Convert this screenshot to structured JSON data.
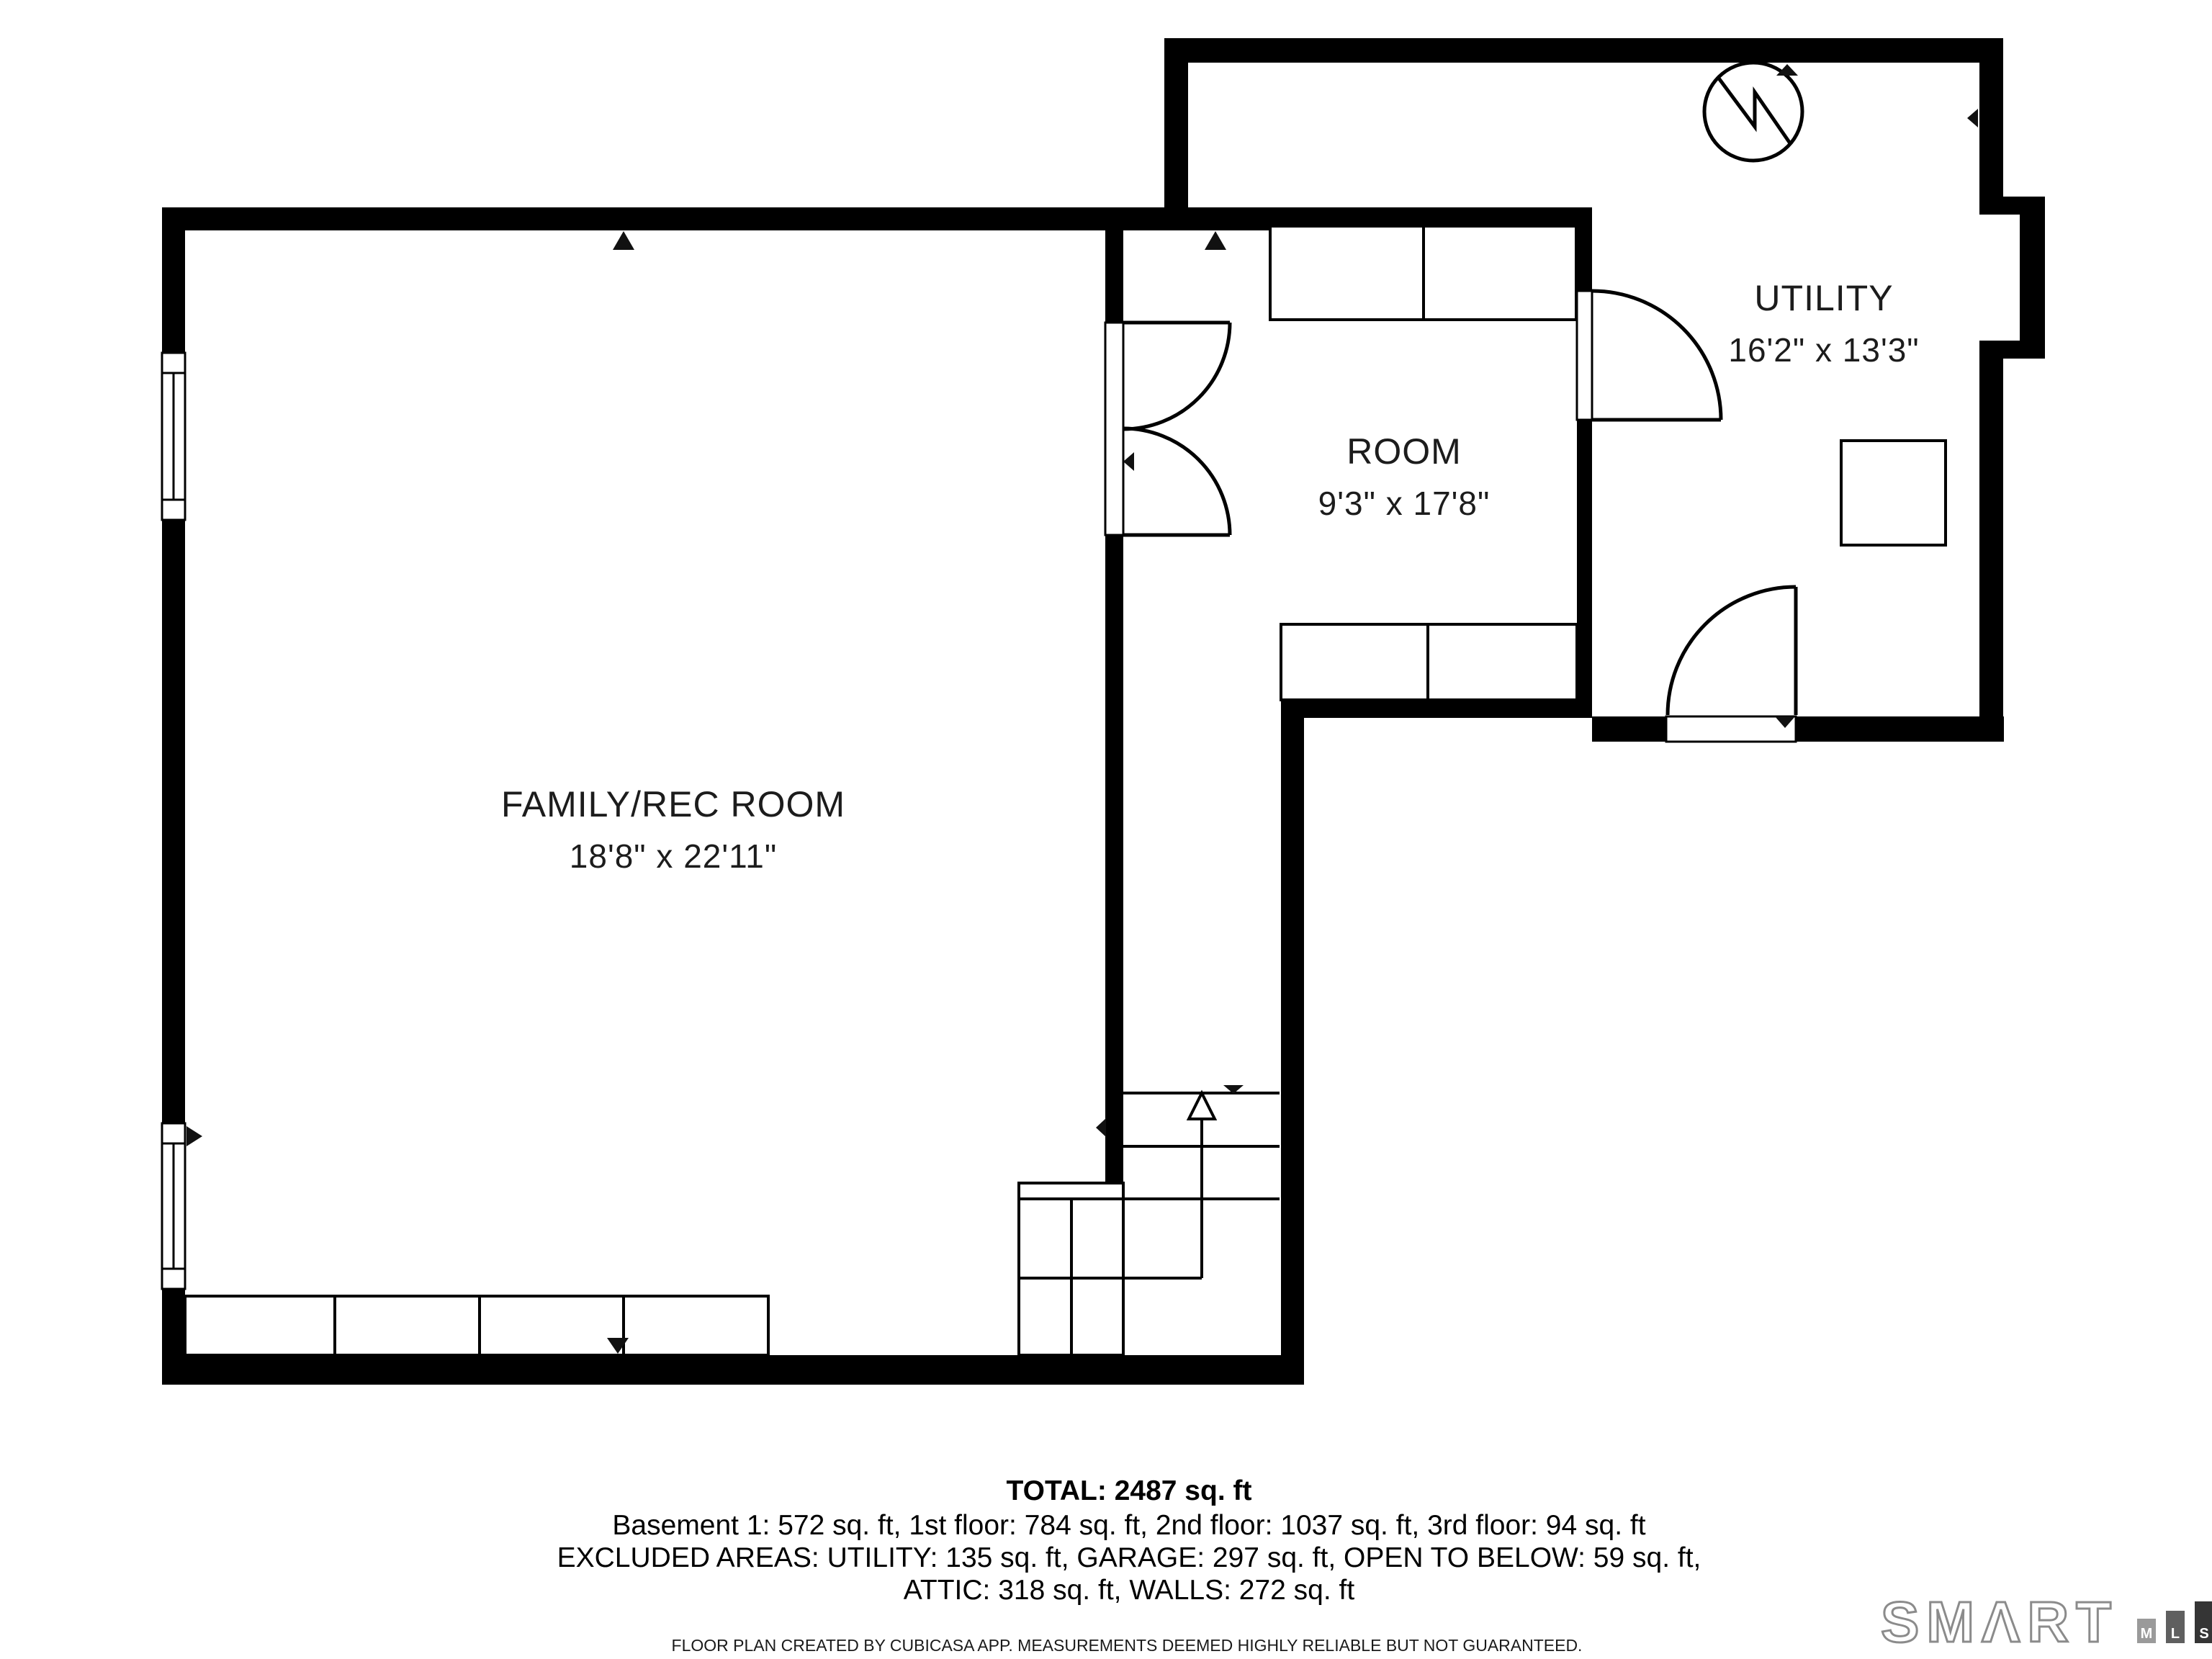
{
  "rooms": {
    "family": {
      "name": "FAMILY/REC ROOM",
      "dims": "18'8\" x 22'11\""
    },
    "room": {
      "name": "ROOM",
      "dims": "9'3\" x 17'8\""
    },
    "utility": {
      "name": "UTILITY",
      "dims": "16'2\" x 13'3\""
    }
  },
  "summary": {
    "total": "TOTAL: 2487 sq. ft",
    "floors": "Basement 1: 572 sq. ft, 1st floor: 784 sq. ft, 2nd floor: 1037 sq. ft, 3rd floor: 94 sq. ft",
    "excluded_line1": "EXCLUDED AREAS: UTILITY: 135 sq. ft, GARAGE: 297 sq. ft, OPEN TO BELOW: 59 sq. ft,",
    "excluded_line2": "ATTIC: 318 sq. ft, WALLS: 272 sq. ft"
  },
  "footer": {
    "disclaimer": "FLOOR PLAN CREATED BY CUBICASA APP. MEASUREMENTS DEEMED HIGHLY RELIABLE BUT NOT GUARANTEED."
  },
  "logo": {
    "brand": "SMΛRT",
    "bars": [
      {
        "letter": "M",
        "color": "#9a9a9a"
      },
      {
        "letter": "L",
        "color": "#5f5f5f"
      },
      {
        "letter": "S",
        "color": "#353535"
      }
    ]
  },
  "icons": {
    "water_heater": "water-heater-circle-zigzag-icon",
    "stairs": "stairs-up-arrow-icon",
    "doors": "door-swing-arc-icon",
    "windows": "window-icon",
    "markers": "scan-direction-marker-icon"
  },
  "colors": {
    "walls": "#000000",
    "background": "#ffffff",
    "logo_outline": "#8b8b8b"
  }
}
